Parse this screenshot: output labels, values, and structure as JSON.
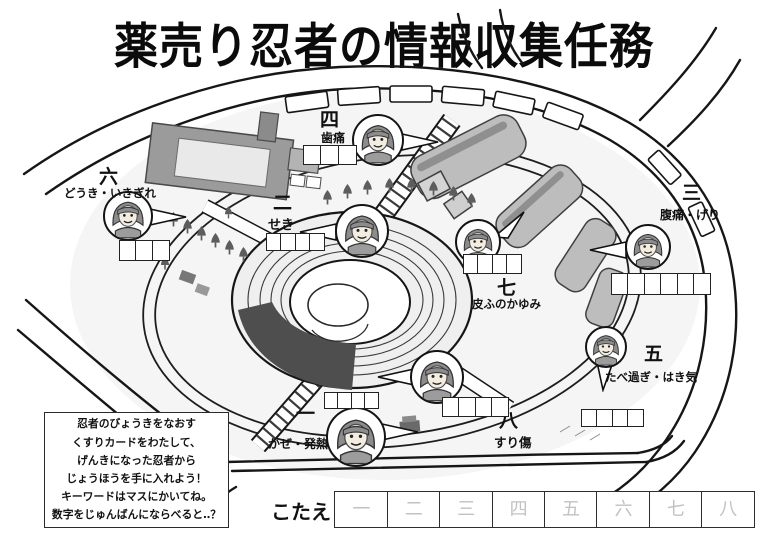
{
  "title": "薬売り忍者の情報収集任務",
  "stations": [
    {
      "number": "一",
      "symptom": "かぜ・発熱",
      "box_count": 4
    },
    {
      "number": "二",
      "symptom": "せき",
      "box_count": 4
    },
    {
      "number": "三",
      "symptom": "腹痛・げり",
      "box_count": 6
    },
    {
      "number": "四",
      "symptom": "歯痛",
      "box_count": 3
    },
    {
      "number": "五",
      "symptom": "たべ過ぎ・はき気",
      "box_count": 4
    },
    {
      "number": "六",
      "symptom": "どうき・いきぎれ",
      "box_count": 3
    },
    {
      "number": "七",
      "symptom": "皮ふのかゆみ",
      "box_count": 4
    },
    {
      "number": "八",
      "symptom": "すり傷",
      "box_count": 4
    }
  ],
  "instructions": {
    "lines": [
      "忍者のびょうきをなおす",
      "くすりカードをわたして、",
      "げんきになった忍者から",
      "じょうほうを手に入れよう！",
      "キーワードはマスにかいてね。",
      "数字をじゅんばんにならべると‥？"
    ]
  },
  "answer": {
    "label": "こたえ",
    "cells": [
      "一",
      "二",
      "三",
      "四",
      "五",
      "六",
      "七",
      "八"
    ]
  },
  "icons": {
    "ninja": "ninja-face-icon",
    "tree": "tree-icon"
  },
  "colors": {
    "ink": "#161616",
    "building_gray": "#9b9b9b",
    "stadium_gray": "#bdbdbd",
    "pond_gray": "#4e4e4e",
    "faint_numeral": "#c2c2c2"
  }
}
